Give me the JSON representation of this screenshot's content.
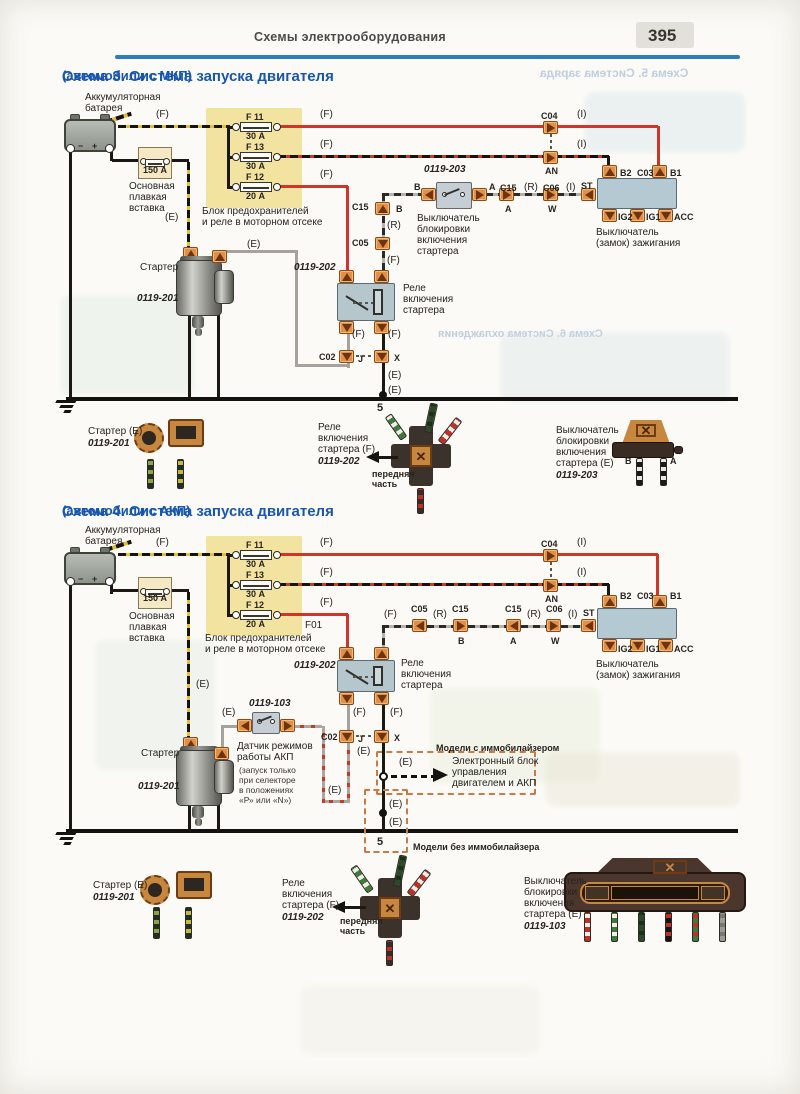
{
  "page": {
    "header": "Схемы электрооборудования",
    "number": "395"
  },
  "ghosts": {
    "top": "Схема 5. Система заряда",
    "mid": "Схема 6. Система охлаждения"
  },
  "colors": {
    "accent_blue": "#1757b0",
    "wire_red": "#cf362a",
    "connector_orange": "#e09048",
    "fuse_block_yellow": "#f0dd8c"
  },
  "schema3": {
    "title": "Схема 3. Система запуска двигателя",
    "subtitle": "(автомобили с МКП)",
    "labels": [
      {
        "t": "Аккумуляторная",
        "x": 85,
        "y": 93
      },
      {
        "t": "батарея",
        "x": 85,
        "y": 104
      },
      {
        "t": "(F)",
        "x": 156,
        "y": 110
      },
      {
        "t": "F 11",
        "x": 246,
        "y": 112,
        "c": "s"
      },
      {
        "t": "30 А",
        "x": 246,
        "y": 131,
        "c": "s"
      },
      {
        "t": "F 13",
        "x": 246,
        "y": 142,
        "c": "s"
      },
      {
        "t": "30 А",
        "x": 246,
        "y": 161,
        "c": "s"
      },
      {
        "t": "F 12",
        "x": 246,
        "y": 172,
        "c": "s"
      },
      {
        "t": "20 А",
        "x": 246,
        "y": 191,
        "c": "s"
      },
      {
        "t": "(F)",
        "x": 320,
        "y": 110
      },
      {
        "t": "(F)",
        "x": 320,
        "y": 140
      },
      {
        "t": "(F)",
        "x": 320,
        "y": 170
      },
      {
        "t": "C04",
        "x": 541,
        "y": 111,
        "c": "s"
      },
      {
        "t": "(I)",
        "x": 577,
        "y": 110
      },
      {
        "t": "AN",
        "x": 545,
        "y": 166,
        "c": "s"
      },
      {
        "t": "(I)",
        "x": 577,
        "y": 140
      },
      {
        "t": "150 А",
        "x": 143,
        "y": 165,
        "c": "s"
      },
      {
        "t": "Основная",
        "x": 129,
        "y": 182
      },
      {
        "t": "плавкая",
        "x": 129,
        "y": 193
      },
      {
        "t": "вставка",
        "x": 129,
        "y": 204
      },
      {
        "t": "Блок предохранителей",
        "x": 202,
        "y": 207
      },
      {
        "t": "и реле в моторном отсеке",
        "x": 202,
        "y": 218
      },
      {
        "t": "(E)",
        "x": 165,
        "y": 213
      },
      {
        "t": "Стартер",
        "x": 140,
        "y": 263
      },
      {
        "t": "0119-201",
        "x": 137,
        "y": 294,
        "c": "it"
      },
      {
        "t": "(E)",
        "x": 247,
        "y": 240
      },
      {
        "t": "0119-203",
        "x": 424,
        "y": 165,
        "c": "it"
      },
      {
        "t": "B",
        "x": 414,
        "y": 182,
        "c": "s"
      },
      {
        "t": "A",
        "x": 489,
        "y": 182,
        "c": "s"
      },
      {
        "t": "Выключатель",
        "x": 417,
        "y": 214
      },
      {
        "t": "блокировки",
        "x": 417,
        "y": 225
      },
      {
        "t": "включения",
        "x": 417,
        "y": 236
      },
      {
        "t": "стартера",
        "x": 417,
        "y": 247
      },
      {
        "t": "C15",
        "x": 352,
        "y": 202,
        "c": "s"
      },
      {
        "t": "B",
        "x": 396,
        "y": 204,
        "c": "s"
      },
      {
        "t": "(R)",
        "x": 387,
        "y": 221
      },
      {
        "t": "C05",
        "x": 352,
        "y": 238,
        "c": "s"
      },
      {
        "t": "(F)",
        "x": 387,
        "y": 256
      },
      {
        "t": "0119-202",
        "x": 294,
        "y": 263,
        "c": "it"
      },
      {
        "t": "Реле",
        "x": 403,
        "y": 284
      },
      {
        "t": "включения",
        "x": 403,
        "y": 295
      },
      {
        "t": "стартера",
        "x": 403,
        "y": 306
      },
      {
        "t": "C15",
        "x": 500,
        "y": 183,
        "c": "s"
      },
      {
        "t": "A",
        "x": 505,
        "y": 204,
        "c": "s"
      },
      {
        "t": "(R)",
        "x": 524,
        "y": 183
      },
      {
        "t": "C06",
        "x": 543,
        "y": 183,
        "c": "s"
      },
      {
        "t": "W",
        "x": 548,
        "y": 204,
        "c": "s"
      },
      {
        "t": "(I)",
        "x": 566,
        "y": 183
      },
      {
        "t": "ST",
        "x": 581,
        "y": 181,
        "c": "s"
      },
      {
        "t": "B2",
        "x": 620,
        "y": 168,
        "c": "s"
      },
      {
        "t": "C03",
        "x": 637,
        "y": 168,
        "c": "s"
      },
      {
        "t": "B1",
        "x": 670,
        "y": 168,
        "c": "s"
      },
      {
        "t": "IG2",
        "x": 618,
        "y": 212,
        "c": "s"
      },
      {
        "t": "IG1",
        "x": 646,
        "y": 212,
        "c": "s"
      },
      {
        "t": "ACC",
        "x": 674,
        "y": 212,
        "c": "s"
      },
      {
        "t": "Выключатель",
        "x": 596,
        "y": 228
      },
      {
        "t": "(замок) зажигания",
        "x": 596,
        "y": 239
      },
      {
        "t": "(F)",
        "x": 352,
        "y": 330
      },
      {
        "t": "(F)",
        "x": 388,
        "y": 330
      },
      {
        "t": "C02",
        "x": 319,
        "y": 352,
        "c": "s"
      },
      {
        "t": "J",
        "x": 358,
        "y": 354,
        "c": "s"
      },
      {
        "t": "X",
        "x": 394,
        "y": 353,
        "c": "s"
      },
      {
        "t": "(E)",
        "x": 388,
        "y": 371
      },
      {
        "t": "(E)",
        "x": 388,
        "y": 386
      },
      {
        "t": "5",
        "x": 377,
        "y": 403,
        "c": "b"
      },
      {
        "t": "Стартер (E)",
        "x": 88,
        "y": 427
      },
      {
        "t": "0119-201",
        "x": 88,
        "y": 439,
        "c": "it"
      },
      {
        "t": "Реле",
        "x": 318,
        "y": 423
      },
      {
        "t": "включения",
        "x": 318,
        "y": 434
      },
      {
        "t": "стартера (F)",
        "x": 318,
        "y": 445
      },
      {
        "t": "0119-202",
        "x": 318,
        "y": 457,
        "c": "it"
      },
      {
        "t": "передняя",
        "x": 372,
        "y": 469,
        "c": "s"
      },
      {
        "t": "часть",
        "x": 372,
        "y": 479,
        "c": "s"
      },
      {
        "t": "Выключатель",
        "x": 556,
        "y": 426
      },
      {
        "t": "блокировки",
        "x": 556,
        "y": 437
      },
      {
        "t": "включения",
        "x": 556,
        "y": 448
      },
      {
        "t": "стартера (E)",
        "x": 556,
        "y": 459
      },
      {
        "t": "0119-203",
        "x": 556,
        "y": 471,
        "c": "it"
      },
      {
        "t": "B",
        "x": 625,
        "y": 456,
        "c": "s"
      },
      {
        "t": "A",
        "x": 670,
        "y": 456,
        "c": "s"
      }
    ]
  },
  "schema4": {
    "title": "Схема 4. Система запуска двигателя",
    "subtitle": "(автомобили с АКП)",
    "labels": [
      {
        "t": "Аккумуляторная",
        "x": 85,
        "y": 526
      },
      {
        "t": "батарея",
        "x": 85,
        "y": 537
      },
      {
        "t": "(F)",
        "x": 156,
        "y": 538
      },
      {
        "t": "F 11",
        "x": 246,
        "y": 540,
        "c": "s"
      },
      {
        "t": "30 А",
        "x": 246,
        "y": 559,
        "c": "s"
      },
      {
        "t": "F 13",
        "x": 246,
        "y": 570,
        "c": "s"
      },
      {
        "t": "30 А",
        "x": 246,
        "y": 589,
        "c": "s"
      },
      {
        "t": "F 12",
        "x": 246,
        "y": 600,
        "c": "s"
      },
      {
        "t": "20 А",
        "x": 246,
        "y": 619,
        "c": "s"
      },
      {
        "t": "(F)",
        "x": 320,
        "y": 538
      },
      {
        "t": "(F)",
        "x": 320,
        "y": 568
      },
      {
        "t": "(F)",
        "x": 320,
        "y": 598
      },
      {
        "t": "C04",
        "x": 541,
        "y": 539,
        "c": "s"
      },
      {
        "t": "(I)",
        "x": 577,
        "y": 538
      },
      {
        "t": "AN",
        "x": 545,
        "y": 594,
        "c": "s"
      },
      {
        "t": "(I)",
        "x": 577,
        "y": 568
      },
      {
        "t": "F01",
        "x": 305,
        "y": 621
      },
      {
        "t": "150 А",
        "x": 143,
        "y": 593,
        "c": "s"
      },
      {
        "t": "Основная",
        "x": 129,
        "y": 612
      },
      {
        "t": "плавкая",
        "x": 129,
        "y": 623
      },
      {
        "t": "вставка",
        "x": 129,
        "y": 634
      },
      {
        "t": "Блок предохранителей",
        "x": 205,
        "y": 634
      },
      {
        "t": "и реле в моторном отсеке",
        "x": 205,
        "y": 645
      },
      {
        "t": "(E)",
        "x": 196,
        "y": 680
      },
      {
        "t": "Стартер",
        "x": 141,
        "y": 749
      },
      {
        "t": "0119-201",
        "x": 138,
        "y": 782,
        "c": "it"
      },
      {
        "t": "(E)",
        "x": 222,
        "y": 708
      },
      {
        "t": "0119-103",
        "x": 249,
        "y": 699,
        "c": "it"
      },
      {
        "t": "Датчик режимов",
        "x": 237,
        "y": 742
      },
      {
        "t": "работы АКП",
        "x": 237,
        "y": 753
      },
      {
        "t": "(запуск только",
        "x": 239,
        "y": 765,
        "c": "tiny"
      },
      {
        "t": "при селекторе",
        "x": 239,
        "y": 775,
        "c": "tiny"
      },
      {
        "t": "в положениях",
        "x": 239,
        "y": 785,
        "c": "tiny"
      },
      {
        "t": "«Р» или «N»)",
        "x": 239,
        "y": 795,
        "c": "tiny"
      },
      {
        "t": "0119-202",
        "x": 294,
        "y": 661,
        "c": "it"
      },
      {
        "t": "Реле",
        "x": 401,
        "y": 659
      },
      {
        "t": "включения",
        "x": 401,
        "y": 670
      },
      {
        "t": "стартера",
        "x": 401,
        "y": 681
      },
      {
        "t": "(F)",
        "x": 384,
        "y": 610
      },
      {
        "t": "C05",
        "x": 411,
        "y": 604,
        "c": "s"
      },
      {
        "t": "(R)",
        "x": 433,
        "y": 610
      },
      {
        "t": "C15",
        "x": 452,
        "y": 604,
        "c": "s"
      },
      {
        "t": "B",
        "x": 458,
        "y": 636,
        "c": "s"
      },
      {
        "t": "C15",
        "x": 505,
        "y": 604,
        "c": "s"
      },
      {
        "t": "A",
        "x": 510,
        "y": 636,
        "c": "s"
      },
      {
        "t": "(R)",
        "x": 527,
        "y": 610
      },
      {
        "t": "C06",
        "x": 546,
        "y": 604,
        "c": "s"
      },
      {
        "t": "W",
        "x": 551,
        "y": 636,
        "c": "s"
      },
      {
        "t": "(I)",
        "x": 568,
        "y": 610
      },
      {
        "t": "ST",
        "x": 583,
        "y": 608,
        "c": "s"
      },
      {
        "t": "B2",
        "x": 620,
        "y": 591,
        "c": "s"
      },
      {
        "t": "C03",
        "x": 637,
        "y": 591,
        "c": "s"
      },
      {
        "t": "B1",
        "x": 670,
        "y": 591,
        "c": "s"
      },
      {
        "t": "IG2",
        "x": 618,
        "y": 644,
        "c": "s"
      },
      {
        "t": "IG1",
        "x": 646,
        "y": 644,
        "c": "s"
      },
      {
        "t": "ACC",
        "x": 674,
        "y": 644,
        "c": "s"
      },
      {
        "t": "Выключатель",
        "x": 596,
        "y": 660
      },
      {
        "t": "(замок) зажигания",
        "x": 596,
        "y": 671
      },
      {
        "t": "(F)",
        "x": 353,
        "y": 708
      },
      {
        "t": "(F)",
        "x": 390,
        "y": 708
      },
      {
        "t": "C02",
        "x": 321,
        "y": 732,
        "c": "s"
      },
      {
        "t": "J",
        "x": 358,
        "y": 734,
        "c": "s"
      },
      {
        "t": "X",
        "x": 394,
        "y": 733,
        "c": "s"
      },
      {
        "t": "(E)",
        "x": 357,
        "y": 747
      },
      {
        "t": "(E)",
        "x": 328,
        "y": 786
      },
      {
        "t": "Модели с иммобилайзером",
        "x": 436,
        "y": 743,
        "c": "s"
      },
      {
        "t": "(E)",
        "x": 399,
        "y": 758
      },
      {
        "t": "Электронный блок",
        "x": 452,
        "y": 757
      },
      {
        "t": "управления",
        "x": 452,
        "y": 768
      },
      {
        "t": "двигателем и АКП",
        "x": 452,
        "y": 779
      },
      {
        "t": "(E)",
        "x": 389,
        "y": 800
      },
      {
        "t": "(E)",
        "x": 389,
        "y": 818
      },
      {
        "t": "5",
        "x": 377,
        "y": 837,
        "c": "b"
      },
      {
        "t": "Модели без иммобилайзера",
        "x": 413,
        "y": 842,
        "c": "s"
      },
      {
        "t": "Стартер (E)",
        "x": 93,
        "y": 881
      },
      {
        "t": "0119-201",
        "x": 93,
        "y": 893,
        "c": "it"
      },
      {
        "t": "Реле",
        "x": 282,
        "y": 879
      },
      {
        "t": "включения",
        "x": 282,
        "y": 890
      },
      {
        "t": "стартера (F)",
        "x": 282,
        "y": 901
      },
      {
        "t": "0119-202",
        "x": 282,
        "y": 913,
        "c": "it"
      },
      {
        "t": "передняя",
        "x": 340,
        "y": 916,
        "c": "s"
      },
      {
        "t": "часть",
        "x": 340,
        "y": 926,
        "c": "s"
      },
      {
        "t": "Выключатель",
        "x": 524,
        "y": 877
      },
      {
        "t": "блокировки",
        "x": 524,
        "y": 888
      },
      {
        "t": "включения",
        "x": 524,
        "y": 899
      },
      {
        "t": "стартера (E)",
        "x": 524,
        "y": 910
      },
      {
        "t": "0119-103",
        "x": 524,
        "y": 922,
        "c": "it"
      }
    ]
  }
}
